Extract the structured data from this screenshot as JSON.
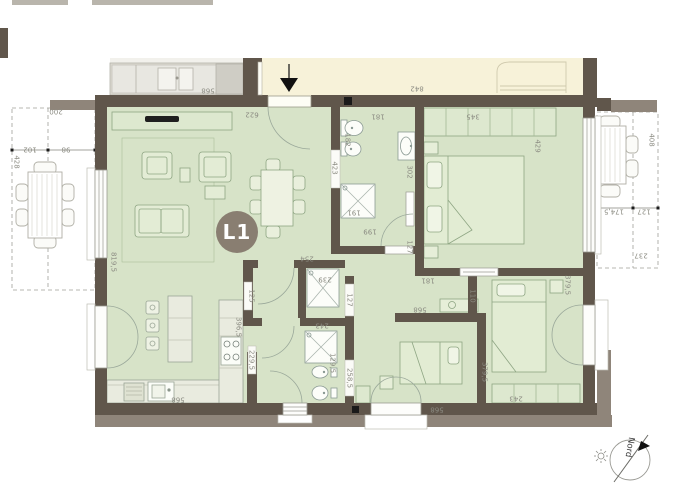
{
  "plan": {
    "unit_label": "L1",
    "north_label": "Nord",
    "colors": {
      "floor": "#d7e3c8",
      "wall": "#60564b",
      "wall_light": "#8f857a",
      "corridor": "#f7f2d9",
      "counter": "#e9ebdf",
      "furniture_line": "#8ea583",
      "dim": "#8b8b82",
      "badge": "#897e71"
    },
    "dimension_labels": [
      {
        "text": "568",
        "x": 208,
        "y": 90,
        "rot": 180
      },
      {
        "text": "842",
        "x": 417,
        "y": 88,
        "rot": 180
      },
      {
        "text": "622",
        "x": 252,
        "y": 114,
        "rot": 180
      },
      {
        "text": "181",
        "x": 378,
        "y": 116,
        "rot": 180
      },
      {
        "text": "345",
        "x": 473,
        "y": 116,
        "rot": 180
      },
      {
        "text": "200",
        "x": 56,
        "y": 111,
        "rot": 180
      },
      {
        "text": "102",
        "x": 30,
        "y": 149,
        "rot": 180
      },
      {
        "text": "98",
        "x": 66,
        "y": 149,
        "rot": 180
      },
      {
        "text": "428",
        "x": 16,
        "y": 162,
        "rot": 90
      },
      {
        "text": "819,5",
        "x": 113,
        "y": 262,
        "rot": 90
      },
      {
        "text": "423",
        "x": 334,
        "y": 168,
        "rot": 90
      },
      {
        "text": "182",
        "x": 347,
        "y": 140,
        "rot": 90
      },
      {
        "text": "191",
        "x": 354,
        "y": 212,
        "rot": 180
      },
      {
        "text": "199",
        "x": 370,
        "y": 231,
        "rot": 180
      },
      {
        "text": "302",
        "x": 409,
        "y": 172,
        "rot": 90
      },
      {
        "text": "127",
        "x": 409,
        "y": 247,
        "rot": 90
      },
      {
        "text": "429",
        "x": 537,
        "y": 146,
        "rot": 90
      },
      {
        "text": "408",
        "x": 651,
        "y": 140,
        "rot": 90
      },
      {
        "text": "174,5",
        "x": 614,
        "y": 211,
        "rot": 180
      },
      {
        "text": "127",
        "x": 644,
        "y": 211,
        "rot": 180
      },
      {
        "text": "237",
        "x": 641,
        "y": 255,
        "rot": 180
      },
      {
        "text": "254",
        "x": 307,
        "y": 258,
        "rot": 180
      },
      {
        "text": "239",
        "x": 325,
        "y": 279,
        "rot": 180
      },
      {
        "text": "125",
        "x": 251,
        "y": 296,
        "rot": 90
      },
      {
        "text": "396,5",
        "x": 238,
        "y": 327,
        "rot": 90
      },
      {
        "text": "229,5",
        "x": 251,
        "y": 360,
        "rot": 90
      },
      {
        "text": "243",
        "x": 322,
        "y": 325,
        "rot": 180
      },
      {
        "text": "129,5",
        "x": 332,
        "y": 363,
        "rot": 90
      },
      {
        "text": "127",
        "x": 349,
        "y": 300,
        "rot": 90
      },
      {
        "text": "258,5",
        "x": 349,
        "y": 378,
        "rot": 90
      },
      {
        "text": "568",
        "x": 420,
        "y": 309,
        "rot": 180
      },
      {
        "text": "110",
        "x": 472,
        "y": 296,
        "rot": 90
      },
      {
        "text": "181",
        "x": 428,
        "y": 280,
        "rot": 180
      },
      {
        "text": "379,5",
        "x": 567,
        "y": 285,
        "rot": 90
      },
      {
        "text": "379,5",
        "x": 484,
        "y": 372,
        "rot": 90
      },
      {
        "text": "568",
        "x": 437,
        "y": 409,
        "rot": 180
      },
      {
        "text": "243",
        "x": 516,
        "y": 398,
        "rot": 180
      },
      {
        "text": "568",
        "x": 178,
        "y": 399,
        "rot": 180
      }
    ]
  }
}
